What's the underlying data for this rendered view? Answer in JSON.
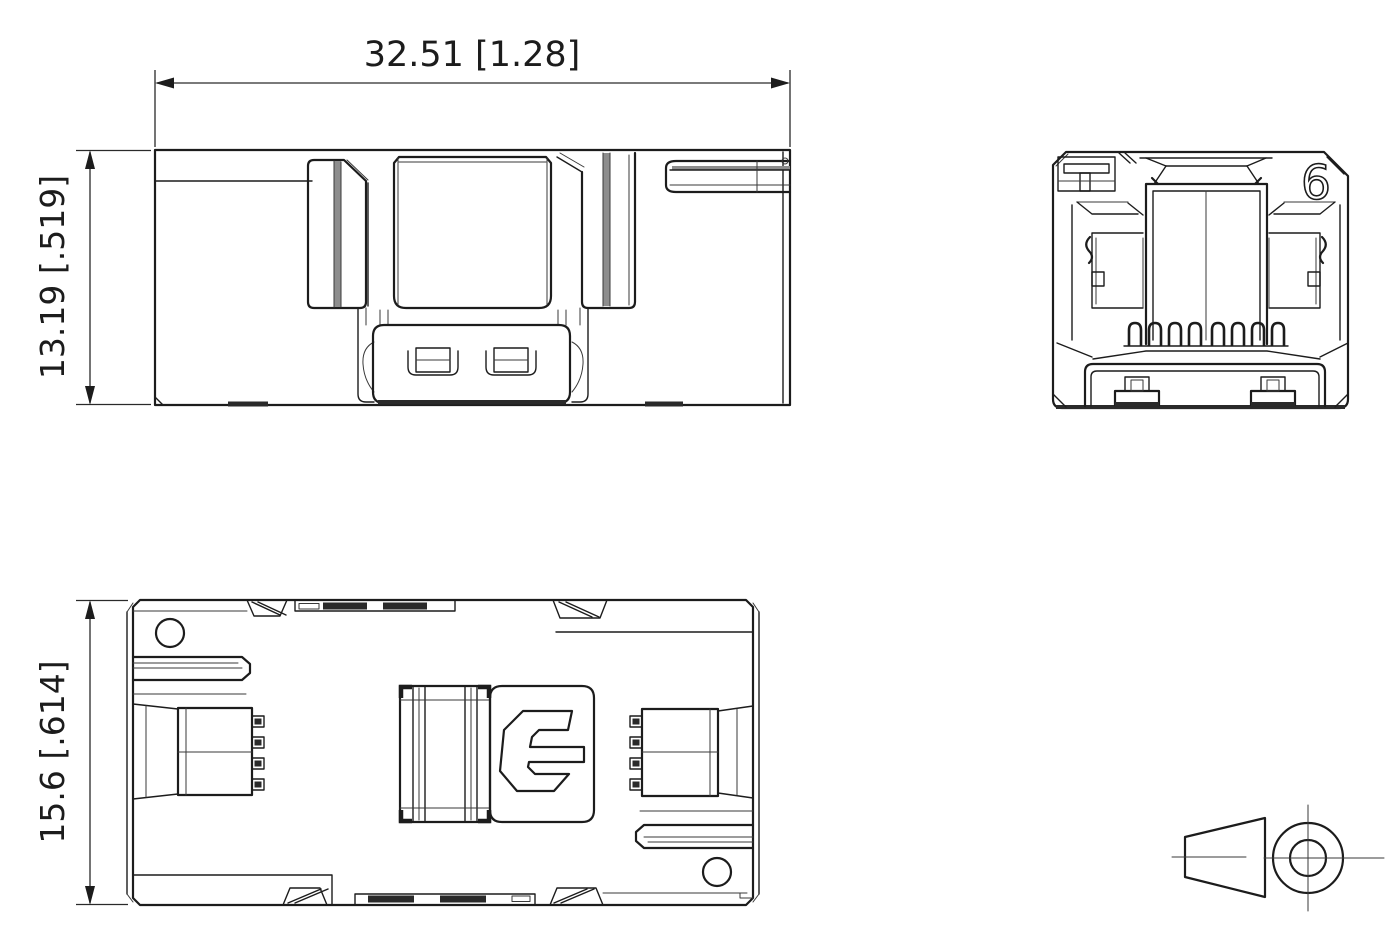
{
  "page": {
    "background": "#ffffff",
    "line_color": "#1c1c1c"
  },
  "dimensions": {
    "overall_width": "32.51 [1.28]",
    "overall_height": "13.19 [.519]",
    "overall_depth": "15.6 [.614]"
  },
  "markings": {
    "cavity_number": "6",
    "brand_logo_letter": "C"
  }
}
